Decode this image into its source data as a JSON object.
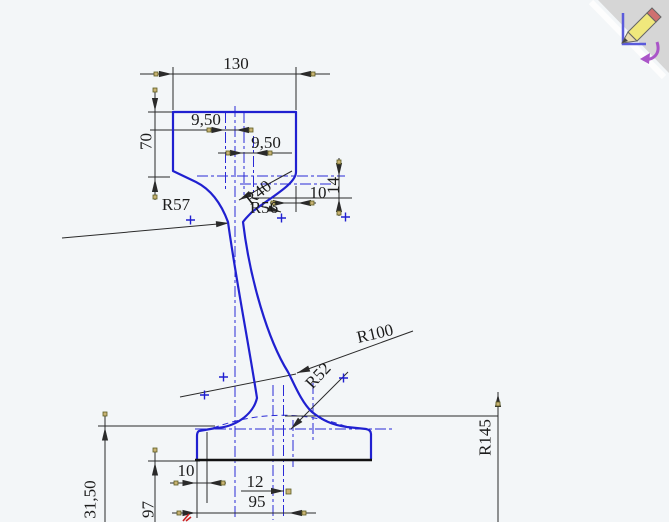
{
  "canvas": {
    "background_color": "#f3f6f8",
    "sketch_color": "#2020d0",
    "dimension_color": "#2a2a2a",
    "handle_color": "#c8b273",
    "origin_color": "#cc2222"
  },
  "labels": {
    "top_width": "130",
    "head_height": "70",
    "head_offset_left": "9,50",
    "head_offset_right": "9,50",
    "head_side_height": "14",
    "web_top_width": "10",
    "radius_left_fillet": "R57",
    "radius_right_fillet_a": "R40",
    "radius_right_fillet_b": "R56",
    "radius_web": "R100",
    "radius_base_fillet": "R52",
    "radius_base_arc": "R145",
    "base_edge_offset": "10",
    "web_base_width": "12",
    "base_width": "95",
    "base_height_left": "31,50",
    "base_height_mid": "97"
  },
  "corner_widget": {
    "name": "sketch confirmation corner",
    "icon": "exit-sketch-pencil-icon"
  }
}
